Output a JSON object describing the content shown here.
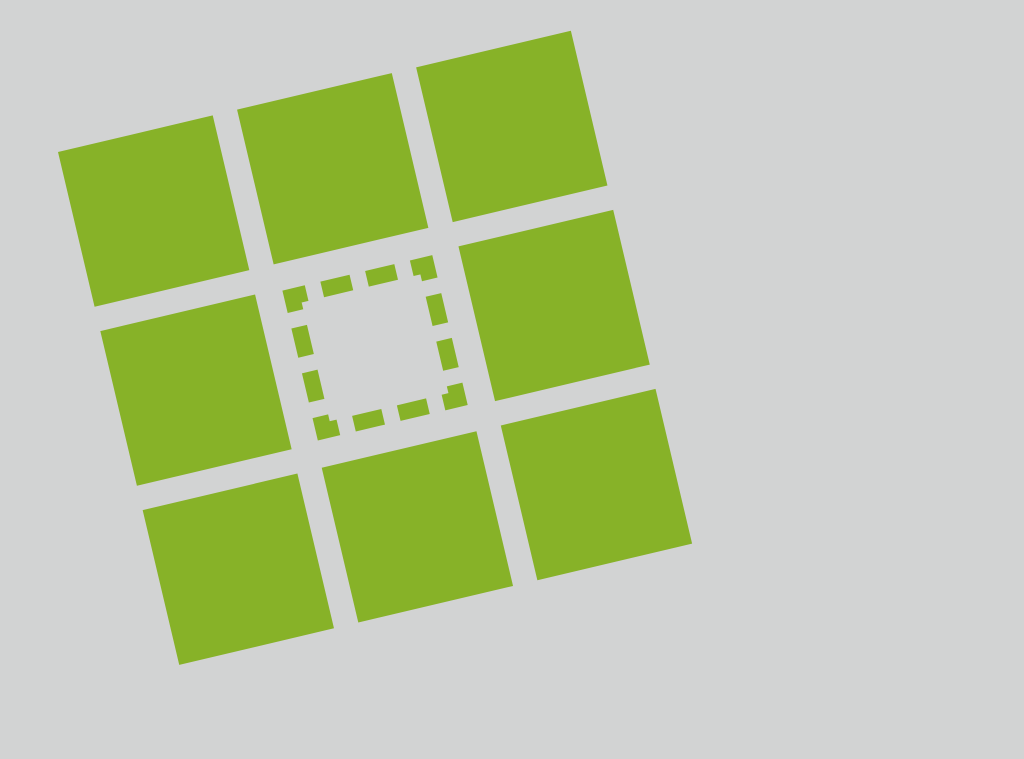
{
  "page": {
    "background_color": "#d2d3d3",
    "description": "Logo graphic: rotated 3x3 grid of green squares with a dashed placeholder outline in the center cell on a plain light-gray background"
  },
  "logo": {
    "square_color": "#87b228",
    "rows": 3,
    "cols": 3,
    "cell_size_px": 159,
    "gap_px": 25,
    "rotation_deg": -13.3,
    "origin_x_px": 58,
    "origin_y_px": 152,
    "cells": [
      {
        "id": "r1c1",
        "type": "filled"
      },
      {
        "id": "r1c2",
        "type": "filled"
      },
      {
        "id": "r1c3",
        "type": "filled"
      },
      {
        "id": "r2c1",
        "type": "filled"
      },
      {
        "id": "r2c2",
        "type": "placeholder"
      },
      {
        "id": "r2c3",
        "type": "filled"
      },
      {
        "id": "r3c1",
        "type": "filled"
      },
      {
        "id": "r3c2",
        "type": "filled"
      },
      {
        "id": "r3c3",
        "type": "filled"
      }
    ],
    "placeholder_outline": {
      "rect_inset_px": 10.5,
      "rect_size_px": 138,
      "stroke_width_px": 16,
      "dash_length_px": 30,
      "dash_gap_px": 16,
      "dash_offset_px": 15
    }
  }
}
